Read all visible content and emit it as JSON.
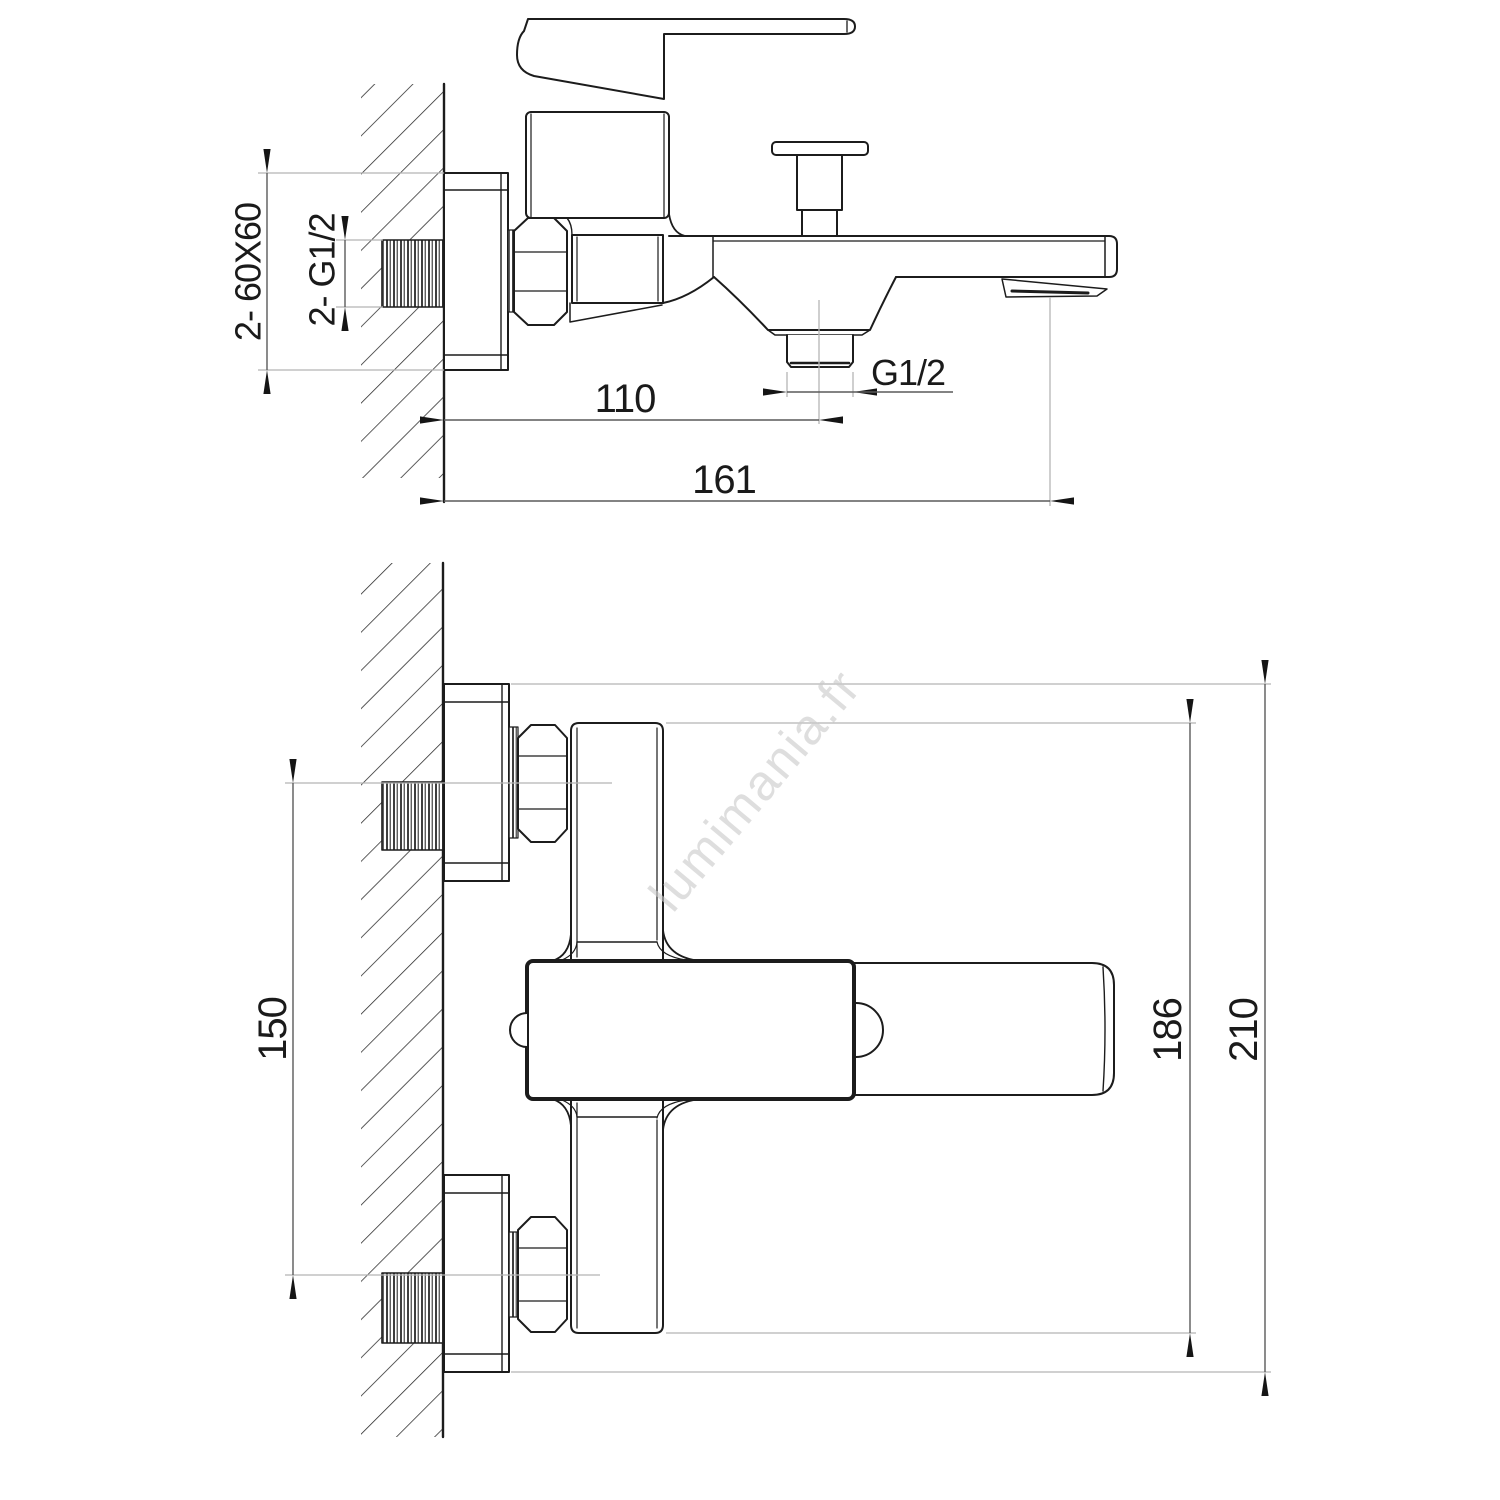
{
  "drawing": {
    "watermark": "lumimania.fr",
    "top_view": {
      "plate_label": "2- 60X60",
      "inlet_thread_label": "2- G1/2",
      "outlet_offset": "110",
      "spout_reach": "161",
      "outlet_thread": "G1/2"
    },
    "front_view": {
      "inlet_spacing": "150",
      "body_height": "186",
      "overall_height": "210"
    },
    "colors": {
      "line": "#1c1c1c",
      "dimension": "#5a5a5a",
      "extension": "#b5b5b5",
      "watermark": "#cbcbcb"
    }
  }
}
